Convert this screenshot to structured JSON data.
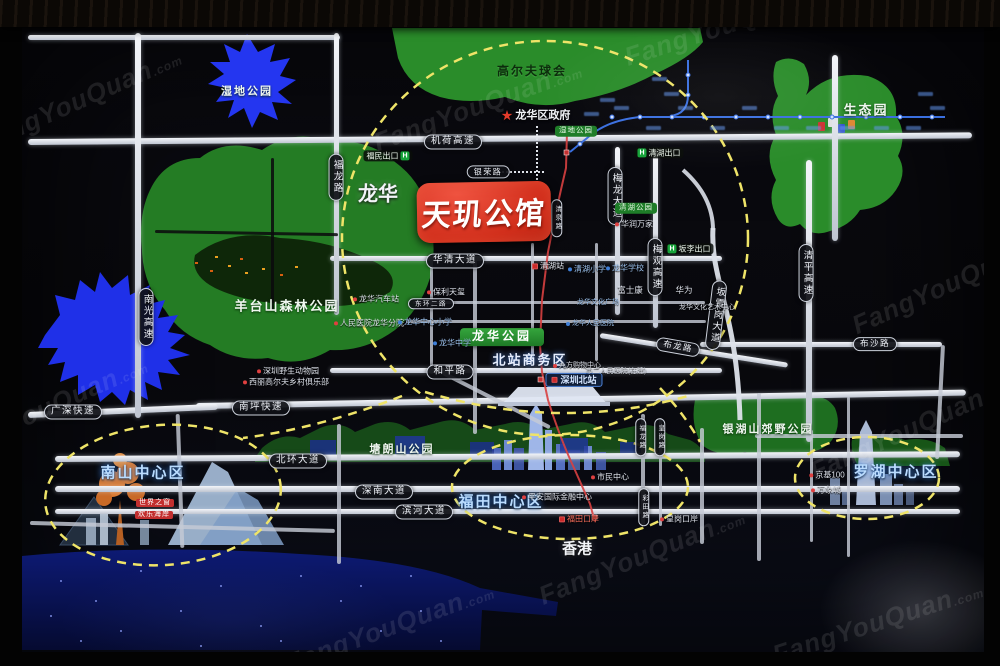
{
  "watermark": {
    "text": "FangYouQuan",
    "suffix": ".com",
    "spots": [
      {
        "x": 80,
        "y": 100,
        "r": -24
      },
      {
        "x": 478,
        "y": 106,
        "r": -20
      },
      {
        "x": 730,
        "y": 24,
        "r": -18
      },
      {
        "x": 954,
        "y": 282,
        "r": -24
      },
      {
        "x": 46,
        "y": 408,
        "r": -24
      },
      {
        "x": 390,
        "y": 627,
        "r": -20
      },
      {
        "x": 642,
        "y": 556,
        "r": -22
      },
      {
        "x": 912,
        "y": 428,
        "r": -24
      },
      {
        "x": 878,
        "y": 622,
        "r": -18
      }
    ]
  },
  "project": {
    "name": "天玑公馆"
  },
  "colors": {
    "park_green": "#2a8c2a",
    "water_blue": "#2233ee",
    "road_white": "#e7eaf0",
    "highlight_dash_yellow": "#efe468",
    "badge_red": "#d02d1a",
    "metro_blue": "#3a6fe0",
    "metro_red": "#d84040"
  },
  "labels": [
    {
      "t": "龙华",
      "x": 378,
      "y": 195,
      "k": "city",
      "s": 20,
      "n": "area-label-longhua"
    },
    {
      "t": "香港",
      "x": 577,
      "y": 549,
      "k": "city",
      "s": 15,
      "n": "area-label-hongkong"
    },
    {
      "t": "北站商务区",
      "x": 530,
      "y": 361,
      "k": "biz",
      "s": 13,
      "n": "area-label-north-station-cbd"
    },
    {
      "t": "南山中心区",
      "x": 143,
      "y": 473,
      "k": "district",
      "n": "district-label-nanshan"
    },
    {
      "t": "福田中心区",
      "x": 501,
      "y": 502,
      "k": "district",
      "n": "district-label-futian"
    },
    {
      "t": "罗湖中心区",
      "x": 896,
      "y": 472,
      "k": "district",
      "n": "district-label-luohu"
    },
    {
      "t": "高尔夫球会",
      "x": 532,
      "y": 72,
      "k": "parkdark",
      "s": 12,
      "n": "golf-club-label"
    },
    {
      "t": "生态园",
      "x": 866,
      "y": 111,
      "k": "park",
      "s": 13
    },
    {
      "t": "湿地公园",
      "x": 247,
      "y": 92,
      "k": "park",
      "s": 11
    },
    {
      "t": "羊台山森林公园",
      "x": 287,
      "y": 307,
      "k": "park",
      "s": 13
    },
    {
      "t": "塘朗山公园",
      "x": 402,
      "y": 450,
      "k": "park",
      "s": 11
    },
    {
      "t": "银湖山郊野公园",
      "x": 768,
      "y": 430,
      "k": "park",
      "s": 11
    },
    {
      "t": "龙华区政府",
      "x": 536,
      "y": 116,
      "k": "gov",
      "s": 11,
      "n": "government-label"
    },
    {
      "t": "机荷高速",
      "x": 453,
      "y": 142,
      "k": "pill"
    },
    {
      "t": "银荣路",
      "x": 488,
      "y": 172,
      "k": "pill",
      "s": 8
    },
    {
      "t": "华清大道",
      "x": 455,
      "y": 261,
      "k": "pill"
    },
    {
      "t": "和平路",
      "x": 450,
      "y": 372,
      "k": "pill"
    },
    {
      "t": "南坪快速",
      "x": 261,
      "y": 408,
      "k": "pill"
    },
    {
      "t": "广深快速",
      "x": 73,
      "y": 412,
      "k": "pill"
    },
    {
      "t": "北环大道",
      "x": 298,
      "y": 461,
      "k": "pill"
    },
    {
      "t": "深南大道",
      "x": 384,
      "y": 492,
      "k": "pill"
    },
    {
      "t": "滨河大道",
      "x": 424,
      "y": 512,
      "k": "pill"
    },
    {
      "t": "布沙路",
      "x": 875,
      "y": 344,
      "k": "pill",
      "s": 8.5
    },
    {
      "t": "布龙路",
      "x": 678,
      "y": 347,
      "k": "pill",
      "s": 8.5,
      "r": 10
    },
    {
      "t": "东环二路",
      "x": 431,
      "y": 304,
      "k": "pill",
      "s": 6.5
    },
    {
      "t": "南光高速",
      "x": 146,
      "y": 317,
      "k": "pillv"
    },
    {
      "t": "福龙路",
      "x": 336,
      "y": 177,
      "k": "pillv"
    },
    {
      "t": "梅龙大道",
      "x": 615,
      "y": 196,
      "k": "pillv"
    },
    {
      "t": "梅观高速",
      "x": 655,
      "y": 267,
      "k": "pillv"
    },
    {
      "t": "清平高速",
      "x": 806,
      "y": 273,
      "k": "pillv"
    },
    {
      "t": "坂雪岗大道",
      "x": 716,
      "y": 315,
      "k": "pillv",
      "r": 7
    },
    {
      "t": "清泉路",
      "x": 557,
      "y": 218,
      "k": "pillv",
      "s": 6.5
    },
    {
      "t": "福龙路",
      "x": 641,
      "y": 437,
      "k": "pillv",
      "s": 6.5
    },
    {
      "t": "皇岗路",
      "x": 660,
      "y": 437,
      "k": "pillv",
      "s": 6.5
    },
    {
      "t": "彩田路",
      "x": 644,
      "y": 507,
      "k": "pillv",
      "s": 6.5
    },
    {
      "t": "湿地公园",
      "x": 576,
      "y": 131,
      "k": "gpill"
    },
    {
      "t": "清湖公园",
      "x": 636,
      "y": 208,
      "k": "gpill"
    },
    {
      "t": "龙华公园",
      "x": 502,
      "y": 337,
      "k": "gbox"
    },
    {
      "t": "福民出口",
      "x": 388,
      "y": 156,
      "k": "exit",
      "hp": "r"
    },
    {
      "t": "清湖出口",
      "x": 659,
      "y": 153,
      "k": "exit",
      "hp": "l"
    },
    {
      "t": "坂李出口",
      "x": 689,
      "y": 249,
      "k": "exit",
      "hp": "l"
    },
    {
      "t": "深圳北站",
      "x": 574,
      "y": 380,
      "k": "station"
    },
    {
      "t": "保利天玺",
      "x": 446,
      "y": 292,
      "k": "poi",
      "d": "r"
    },
    {
      "t": "龙华汽车站",
      "x": 376,
      "y": 299,
      "k": "poi",
      "d": "r"
    },
    {
      "t": "人民医院龙华分院",
      "x": 369,
      "y": 323,
      "k": "poi",
      "d": "r"
    },
    {
      "t": "深圳野生动物园",
      "x": 288,
      "y": 371,
      "k": "poi",
      "d": "r"
    },
    {
      "t": "西丽高尔夫乡村俱乐部",
      "x": 286,
      "y": 382,
      "k": "poi",
      "d": "r"
    },
    {
      "t": "龙华中心小学",
      "x": 425,
      "y": 322,
      "k": "poi",
      "c": "b",
      "d": "b"
    },
    {
      "t": "龙华中学",
      "x": 452,
      "y": 343,
      "k": "poi",
      "c": "b",
      "d": "b"
    },
    {
      "t": "清湖小学",
      "x": 587,
      "y": 269,
      "k": "poi",
      "c": "b",
      "d": "b"
    },
    {
      "t": "龙华学校",
      "x": 625,
      "y": 268,
      "k": "poi",
      "c": "b",
      "d": "b"
    },
    {
      "t": "华润万家",
      "x": 634,
      "y": 224,
      "k": "poi",
      "d": "r"
    },
    {
      "t": "清湖站",
      "x": 548,
      "y": 266,
      "k": "poi",
      "d": "m"
    },
    {
      "t": "富士康",
      "x": 630,
      "y": 291,
      "k": "poi",
      "s": 8.5
    },
    {
      "t": "华为",
      "x": 684,
      "y": 291,
      "k": "poi",
      "s": 8.5
    },
    {
      "t": "龙华文化广场",
      "x": 598,
      "y": 303,
      "k": "poi",
      "c": "b",
      "s": 7
    },
    {
      "t": "龙华文化艺术中心",
      "x": 707,
      "y": 308,
      "k": "poi",
      "s": 7
    },
    {
      "t": "龙华人民医院",
      "x": 590,
      "y": 324,
      "k": "poi",
      "c": "b",
      "s": 7,
      "d": "b"
    },
    {
      "t": "九方购物中心",
      "x": 577,
      "y": 366,
      "k": "poi",
      "s": 7,
      "d": "r"
    },
    {
      "t": "市二人民医院(在建)",
      "x": 616,
      "y": 372,
      "k": "poi",
      "s": 7
    },
    {
      "t": "市民中心",
      "x": 610,
      "y": 477,
      "k": "poi",
      "d": "r"
    },
    {
      "t": "平安国际金融中心",
      "x": 557,
      "y": 497,
      "k": "poi",
      "d": "r"
    },
    {
      "t": "福田口岸",
      "x": 579,
      "y": 519,
      "k": "poi",
      "c": "r",
      "d": "m"
    },
    {
      "t": "皇岗口岸",
      "x": 679,
      "y": 519,
      "k": "poi",
      "d": "r"
    },
    {
      "t": "京基100",
      "x": 827,
      "y": 475,
      "k": "poi",
      "d": "r"
    },
    {
      "t": "万象城",
      "x": 826,
      "y": 490,
      "k": "poi",
      "d": "r"
    },
    {
      "t": "世界之窗",
      "x": 155,
      "y": 503,
      "k": "rpill"
    },
    {
      "t": "欢乐海岸",
      "x": 154,
      "y": 515,
      "k": "rpill"
    }
  ],
  "metro_smudges": [
    [
      614,
      106
    ],
    [
      646,
      126
    ],
    [
      678,
      106
    ],
    [
      710,
      126
    ],
    [
      742,
      106
    ],
    [
      774,
      126
    ],
    [
      806,
      126
    ],
    [
      840,
      126
    ],
    [
      874,
      126
    ],
    [
      906,
      126
    ],
    [
      930,
      106
    ],
    [
      652,
      77
    ],
    [
      664,
      92
    ],
    [
      600,
      98
    ],
    [
      584,
      112
    ],
    [
      918,
      92
    ]
  ],
  "sea_sparkles": [
    [
      60,
      580
    ],
    [
      95,
      600
    ],
    [
      140,
      570
    ],
    [
      180,
      610
    ],
    [
      220,
      585
    ],
    [
      260,
      625
    ],
    [
      300,
      575
    ],
    [
      340,
      600
    ],
    [
      380,
      630
    ],
    [
      120,
      630
    ],
    [
      80,
      640
    ],
    [
      200,
      645
    ],
    [
      280,
      640
    ],
    [
      360,
      585
    ],
    [
      420,
      610
    ],
    [
      50,
      615
    ],
    [
      440,
      640
    ],
    [
      410,
      575
    ]
  ],
  "mountain_lights": [
    [
      195,
      262
    ],
    [
      210,
      270
    ],
    [
      228,
      265
    ],
    [
      245,
      272
    ],
    [
      262,
      268
    ],
    [
      280,
      274
    ],
    [
      295,
      266
    ],
    [
      240,
      258
    ],
    [
      215,
      256
    ]
  ],
  "eco_buildings": [
    [
      818,
      122,
      "#cc3333"
    ],
    [
      828,
      118,
      "#e0e0e0"
    ],
    [
      838,
      124,
      "#3355cc"
    ],
    [
      848,
      120,
      "#dd8833"
    ]
  ]
}
